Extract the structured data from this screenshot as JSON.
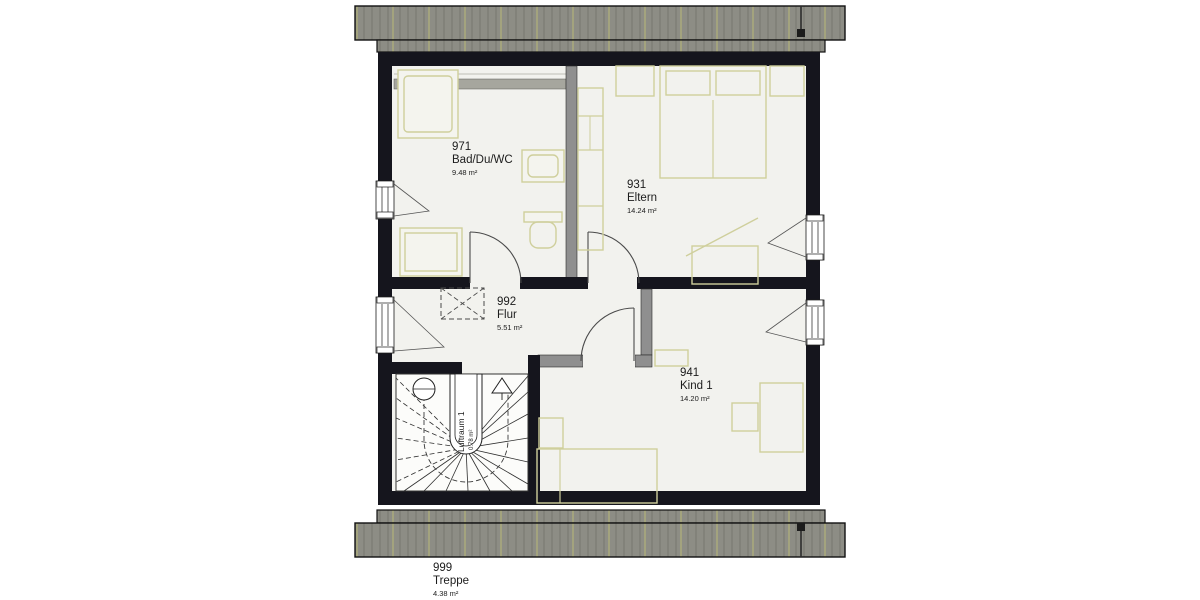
{
  "plan": {
    "type": "floor-plan",
    "floor": "attic / Dachgeschoss"
  },
  "rooms": {
    "bad": {
      "id": "971",
      "name": "Bad/Du/WC",
      "area": "9.48 m²"
    },
    "eltern": {
      "id": "931",
      "name": "Eltern",
      "area": "14.24 m²"
    },
    "flur": {
      "id": "992",
      "name": "Flur",
      "area": "5.51 m²"
    },
    "kind": {
      "id": "941",
      "name": "Kind 1",
      "area": "14.20 m²"
    },
    "treppe": {
      "id": "999",
      "name": "Treppe",
      "area": "4.38 m²"
    }
  },
  "stair": {
    "luftraum_label": "Luftraum 1",
    "luftraum_area": "0.78 m²"
  },
  "colors": {
    "roof": "#8d8d85",
    "roof_hatch": "#77776f",
    "roof_hatch_accent": "#b9b978",
    "wall": "#15151d",
    "interior_wall_gray": "#8f8f8f",
    "floor": "#f2f2ee",
    "furniture_outline": "#cfcf9c",
    "text": "#1c1c1c"
  }
}
